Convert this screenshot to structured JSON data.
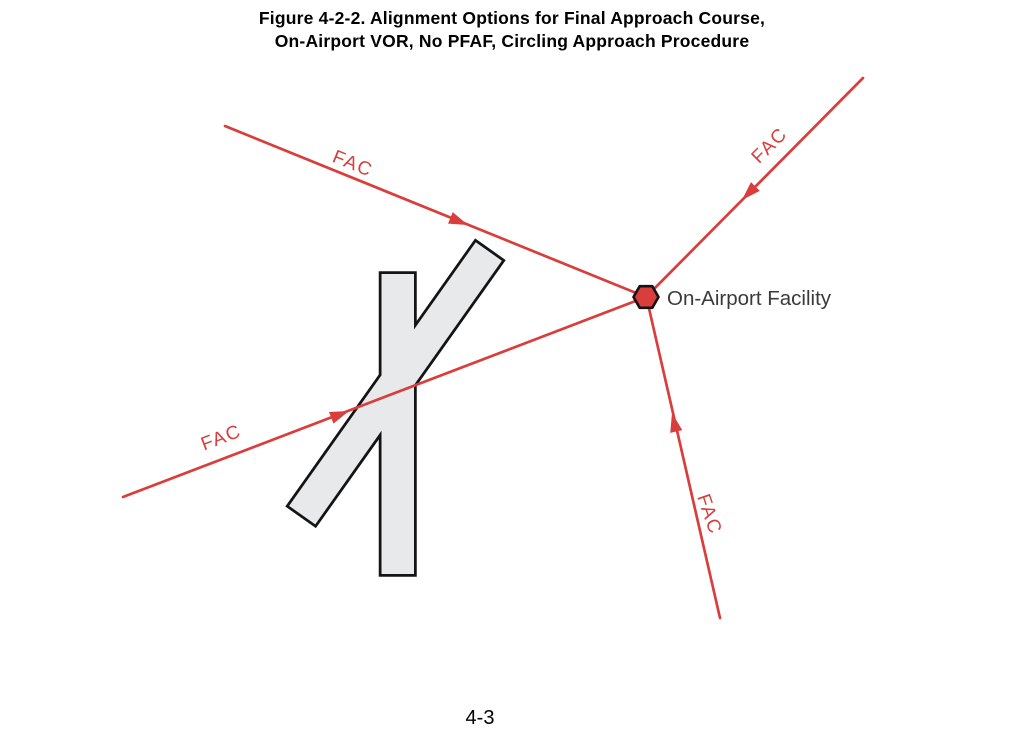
{
  "figure": {
    "title_line1": "Figure 4-2-2. Alignment Options for Final Approach Course,",
    "title_line2": "On-Airport VOR, No PFAF, Circling Approach Procedure",
    "page_number": "4-3"
  },
  "diagram": {
    "fac_label": "FAC",
    "facility_label": "On-Airport Facility",
    "colors": {
      "fac_line": "#d93d3c",
      "facility_fill": "#d93d3c",
      "facility_outline": "#141414",
      "runway_fill": "#e8e9eb",
      "runway_outline": "#141414",
      "label_text": "#3a3a3a",
      "title_text": "#000000"
    }
  }
}
